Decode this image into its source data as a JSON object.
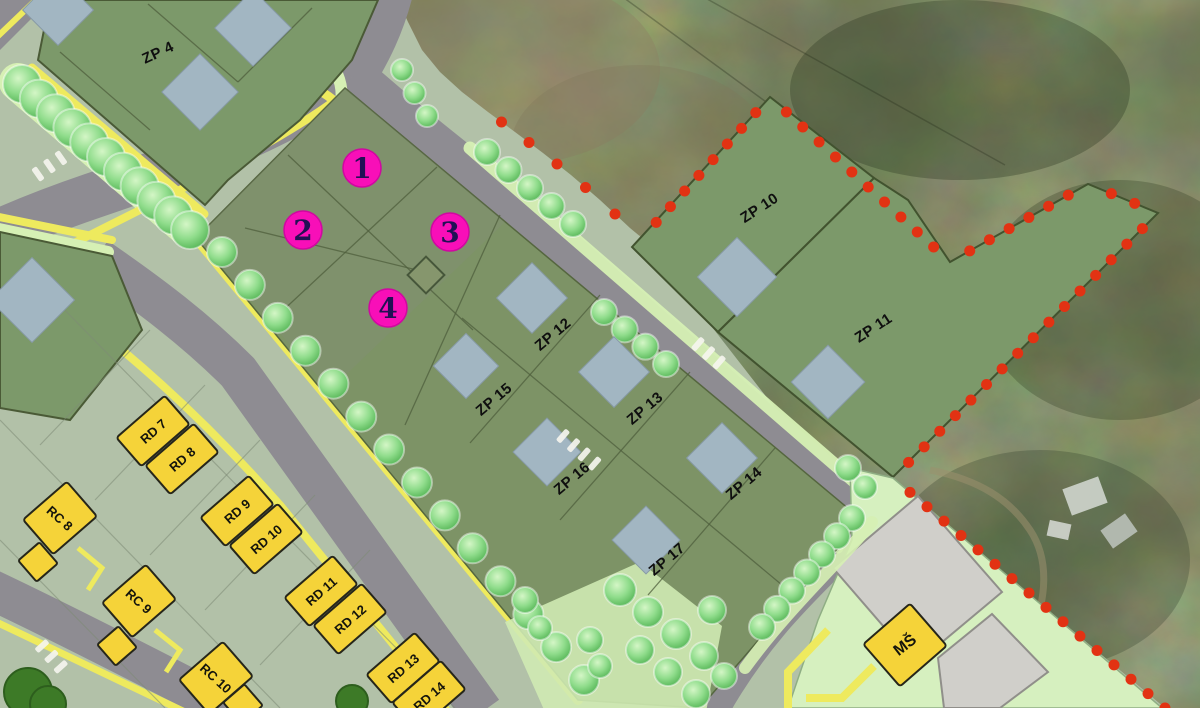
{
  "map": {
    "markers": [
      {
        "label": "1"
      },
      {
        "label": "2"
      },
      {
        "label": "3"
      },
      {
        "label": "4"
      }
    ],
    "zp_plots": [
      {
        "id": "zp4",
        "label": "ZP 4"
      },
      {
        "id": "zp10",
        "label": "ZP 10"
      },
      {
        "id": "zp11",
        "label": "ZP 11"
      },
      {
        "id": "zp12",
        "label": "ZP 12"
      },
      {
        "id": "zp13",
        "label": "ZP 13"
      },
      {
        "id": "zp14",
        "label": "ZP 14"
      },
      {
        "id": "zp15",
        "label": "ZP 15"
      },
      {
        "id": "zp16",
        "label": "ZP 16"
      },
      {
        "id": "zp17",
        "label": "ZP 17"
      }
    ],
    "rd_houses": [
      {
        "label": "RD 7"
      },
      {
        "label": "RD 8"
      },
      {
        "label": "RD 9"
      },
      {
        "label": "RD 10"
      },
      {
        "label": "RD 11"
      },
      {
        "label": "RD 12"
      },
      {
        "label": "RD 13"
      },
      {
        "label": "RD 14"
      }
    ],
    "rc_houses": [
      {
        "label": "RC 8"
      },
      {
        "label": "RC 9"
      },
      {
        "label": "RC 10"
      }
    ],
    "school": {
      "label": "MŠ"
    },
    "colors": {
      "boundary_dots": "#e23213",
      "marker_fill": "#f80fb8",
      "marker_ring": "#cf08a0",
      "marker_text": "#221055",
      "plot_green": "#7c996a",
      "block_green": "#7d9366",
      "house_blue": "#a2b6c2",
      "building_yellow": "#f5d339",
      "road_grey": "#8e8c92",
      "verge_light": "#d6f0b4",
      "strip_yellow": "#eeea5e",
      "zone_sage": "#b2c1a8",
      "school_zone_green": "#d6f0bf",
      "paved_grey": "#d0cfca",
      "label_text": "#0f0f0f"
    }
  }
}
